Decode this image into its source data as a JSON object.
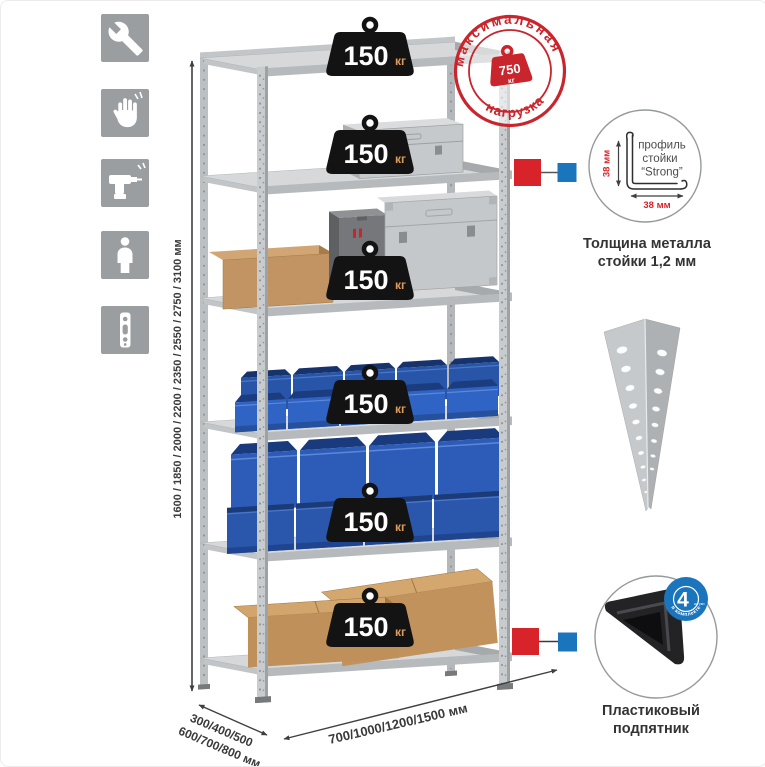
{
  "sidebar": {
    "icons": [
      "wrench",
      "gloves",
      "drill",
      "person",
      "perforated-profile"
    ]
  },
  "dimensions": {
    "height": "1600 / 1850 / 2000 / 2200 / 2350 / 2550 / 2750 / 3100 мм",
    "depth_line1": "300/400/500",
    "depth_line2": "600/700/800 мм",
    "width": "700/1000/1200/1500 мм"
  },
  "stamp": {
    "arc_top": "максимальная",
    "arc_bottom": "нагрузка",
    "value": "750",
    "unit": "кг"
  },
  "badge": {
    "value": "150",
    "unit": "кг"
  },
  "profile_detail": {
    "line1": "профиль",
    "line2": "стойки",
    "line3": "“Strong”",
    "dim_v": "38 мм",
    "dim_h": "38 мм",
    "caption1": "Толщина металла",
    "caption2": "стойки 1,2 мм"
  },
  "foot_detail": {
    "count": "4",
    "count_note": "штуки",
    "arc": "в комплекте",
    "caption1": "Пластиковый",
    "caption2": "подпятник"
  },
  "colors": {
    "accent_red": "#cf2128",
    "accent_blue": "#1b75bc",
    "badge_bg": "#131313",
    "badge_unit": "#dd9c5a",
    "metal_gray": "#c7c9cb",
    "bin_blue": "#2d5db8",
    "cardboard": "#c29463",
    "icon_tile_gray": "#9b9ea1"
  }
}
